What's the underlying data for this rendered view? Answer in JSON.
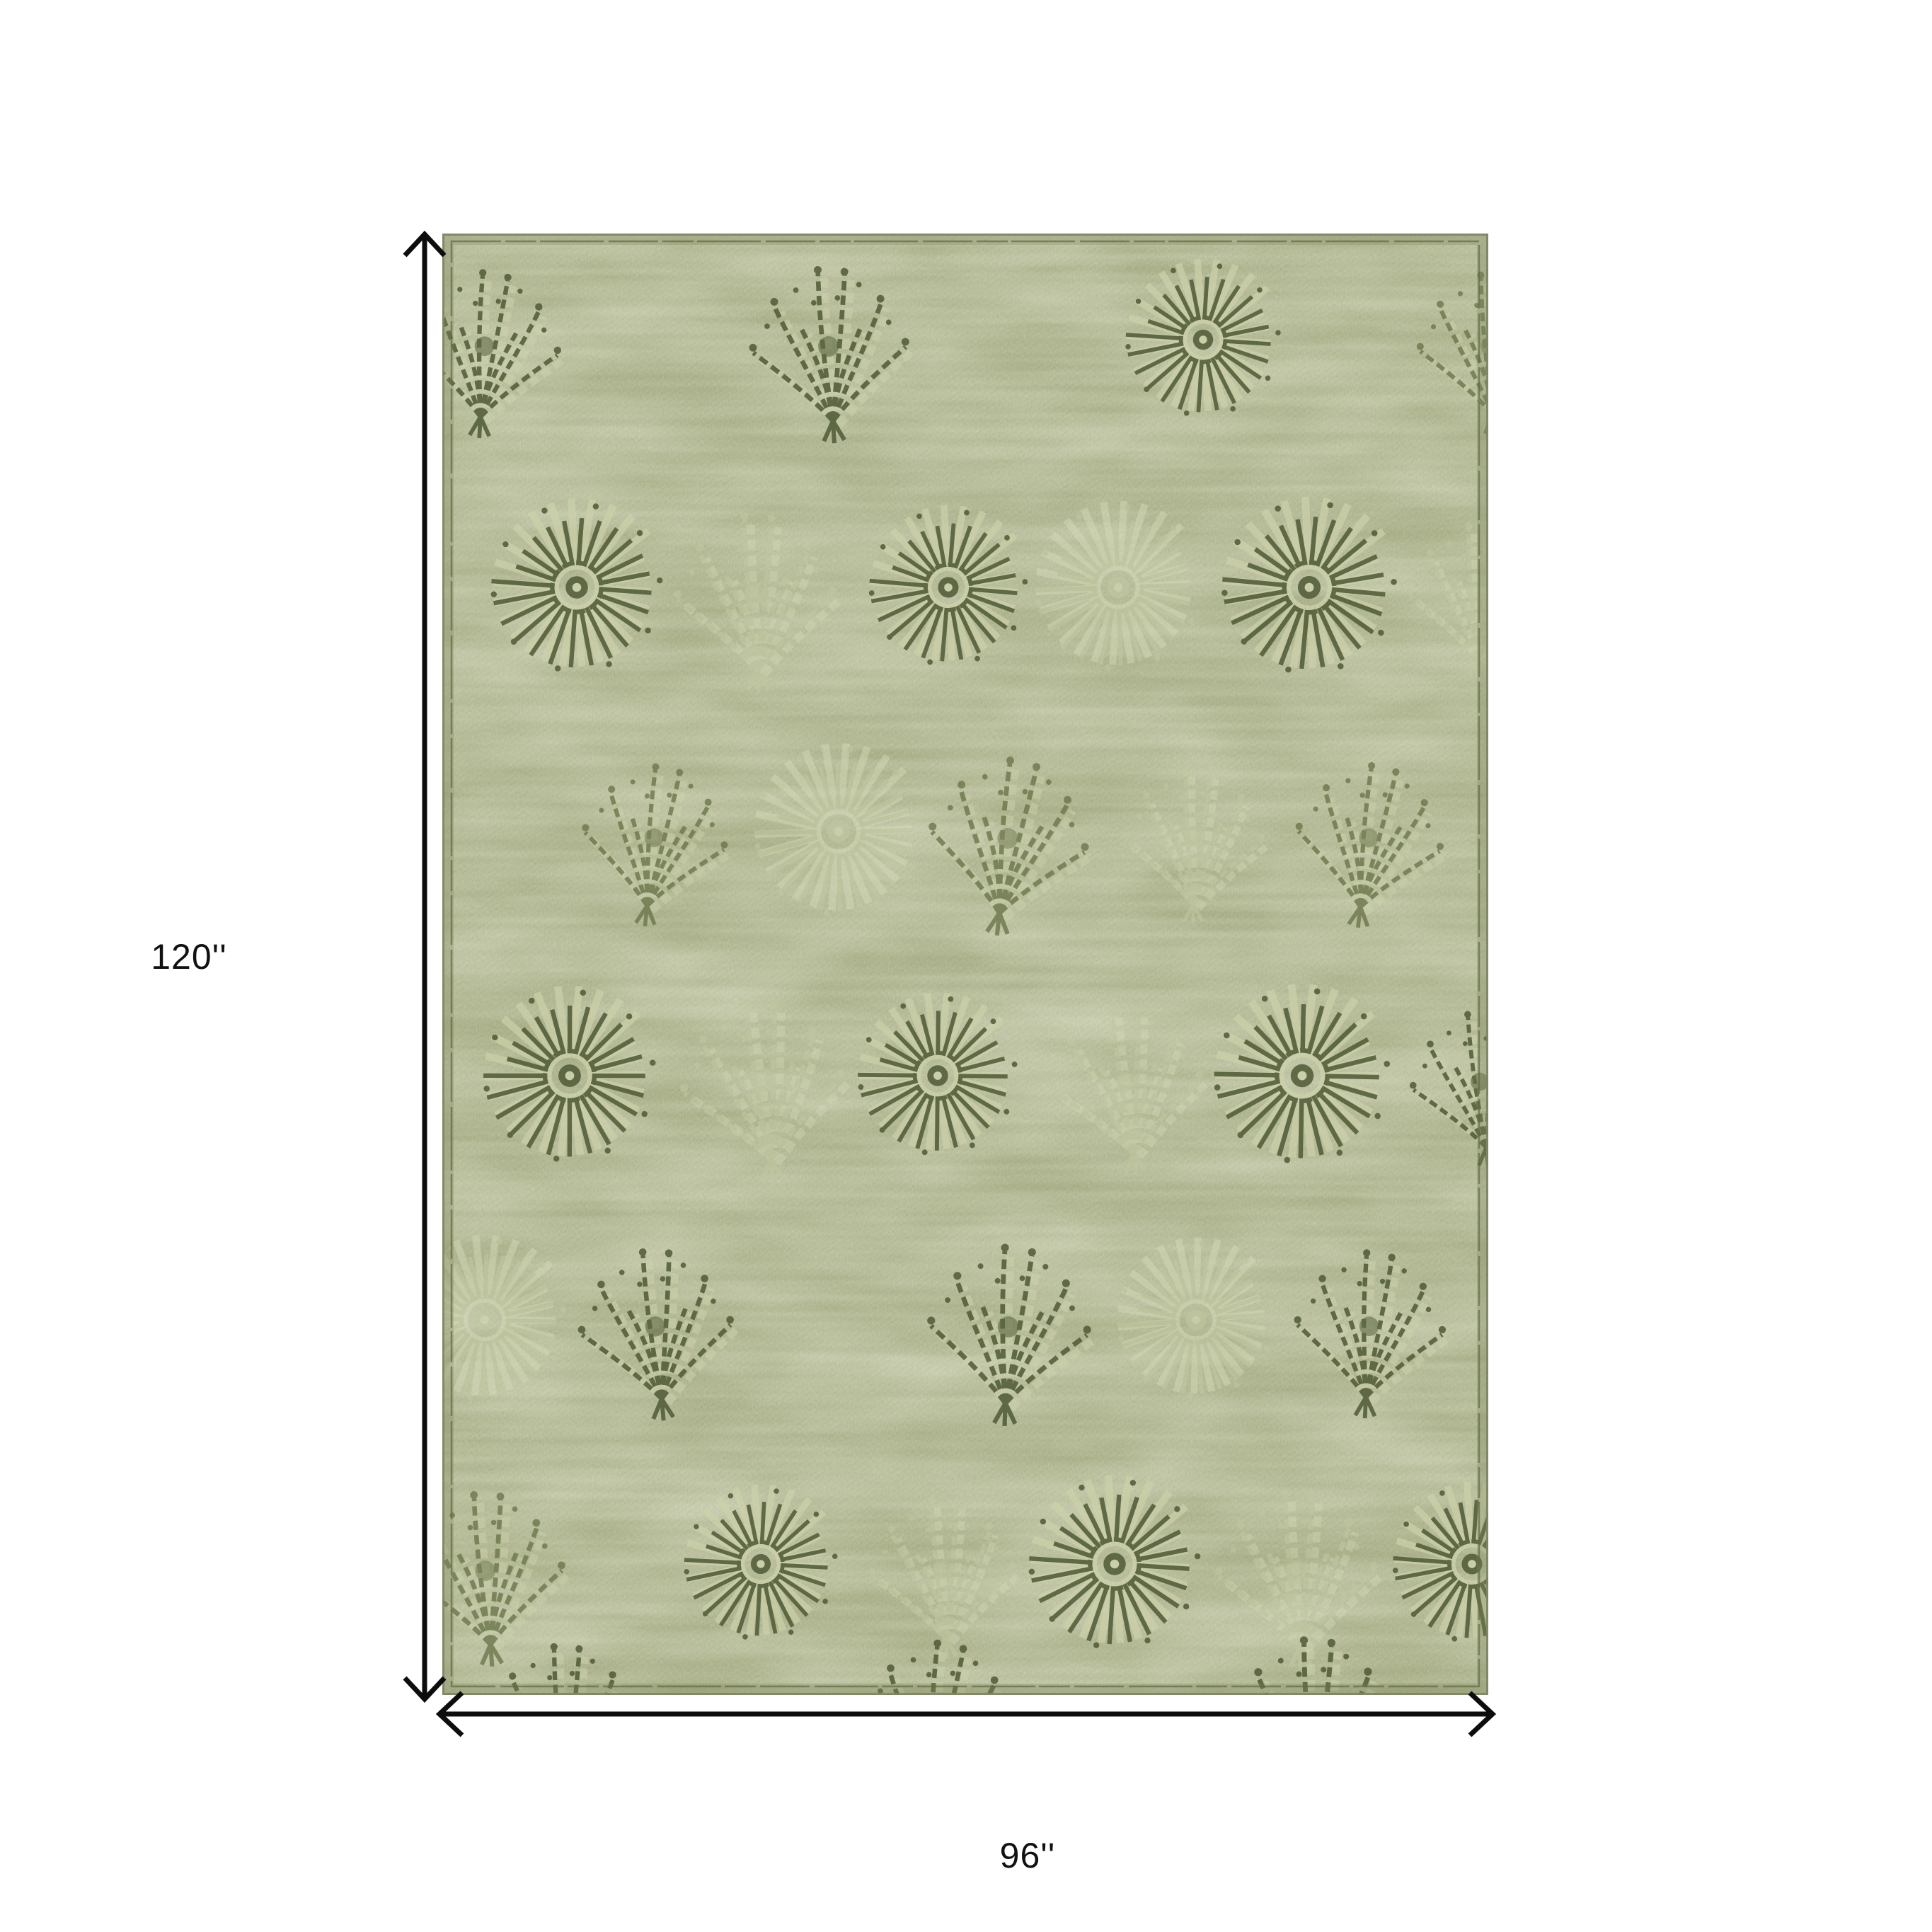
{
  "diagram": {
    "height_label": "120''",
    "width_label": "96''"
  },
  "rug": {
    "base_color": "#a6ac84",
    "shade_color": "#7b835c",
    "highlight_color": "#d8dbbc",
    "motif_dark": "#4f5a36",
    "motif_mid": "#6a7549",
    "motif_ghost": "#c2c8a0",
    "motif_halo": "#cdd2ab",
    "stitch_color": "#5e6940",
    "edge_color": "#7d8562"
  },
  "arrows": {
    "color": "#0d0d0d"
  }
}
